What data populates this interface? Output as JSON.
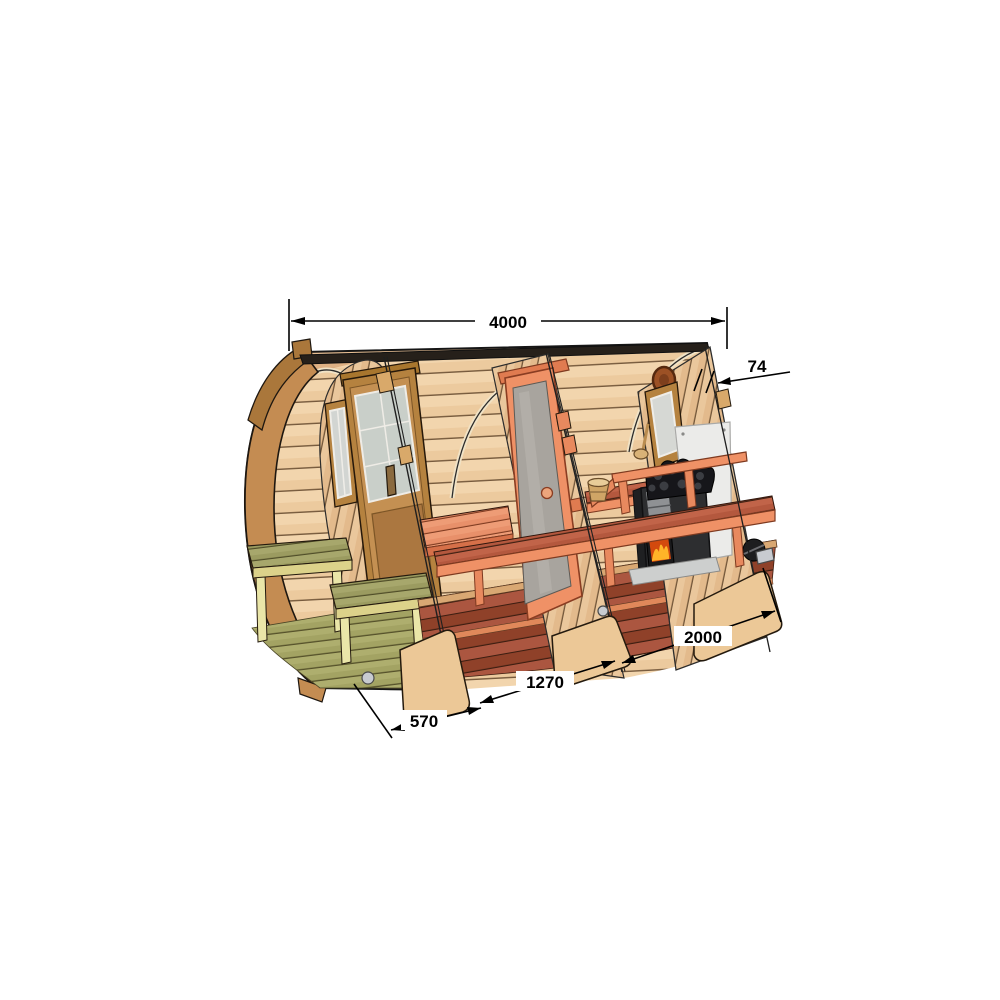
{
  "illustration": {
    "subject": "barrel-sauna-cutaway-technical-drawing",
    "background": "#ffffff"
  },
  "dimension_labels": {
    "overall_length": "4000",
    "wall_thickness": "74",
    "rear_section_length": "2000",
    "middle_section_length": "1270",
    "porch_section_length": "570"
  },
  "palette": {
    "wood_exterior": "#deb184",
    "wood_interior": "#ecca9e",
    "wood_hoop": "#c48c52",
    "accent_salmon": "#ef9166",
    "bench_redwood": "#b4583e",
    "floor_redwood": "#9c4630",
    "porch_wood_yellow": "#eae6a8",
    "porch_slat_olive": "#9b9b60",
    "stove_black": "#2d2e30",
    "fire_orange": "#ff7a1a",
    "shield_white": "#ebebe9",
    "glass_gray": "#a8a49e",
    "dimension_line": "#000000"
  }
}
